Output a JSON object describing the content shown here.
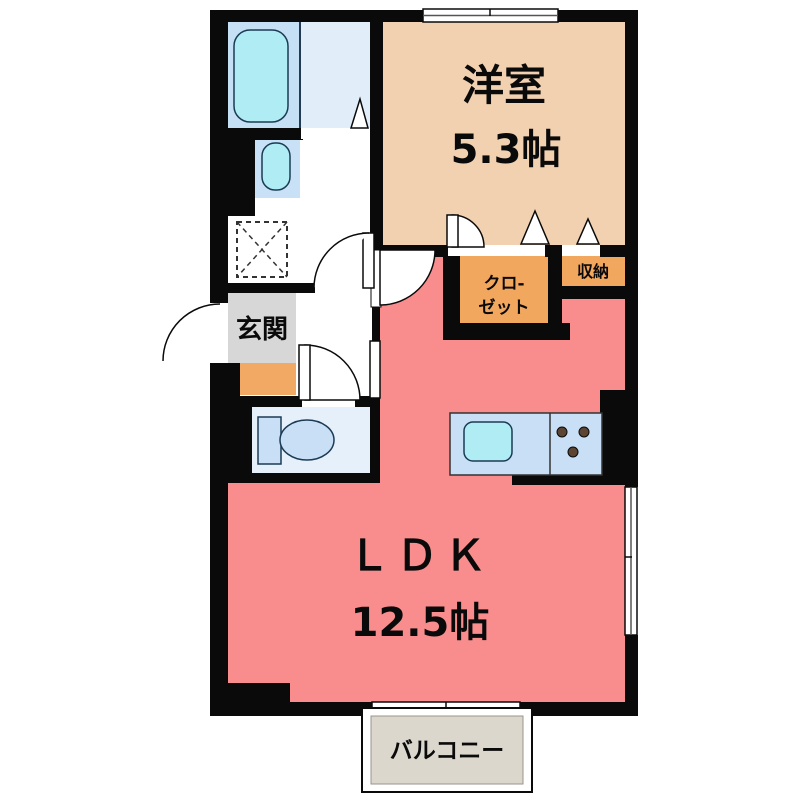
{
  "floor_plan": {
    "western_room": {
      "label": "洋室",
      "size": "5.3帖"
    },
    "ldk": {
      "label": "ＬＤＫ",
      "size": "12.5帖"
    },
    "genkan": {
      "label": "玄関"
    },
    "closet": {
      "label_line1": "クロ-",
      "label_line2": "ゼット"
    },
    "storage": {
      "label": "収納"
    },
    "balcony": {
      "label": "バルコニー"
    },
    "fixtures": [
      "bathtub",
      "washbasin",
      "toilet",
      "kitchen-sink",
      "stove-burners",
      "washing-machine-space"
    ]
  },
  "colors": {
    "wall": "#0a0a0a",
    "ldk": "#F98D8D",
    "western_room": "#F2D1B0",
    "closet": "#F2A75F",
    "storage": "#F2A75F",
    "genkan_floor": "#D7D7D7",
    "step": "#F2A964",
    "bath_left": "#C5DFF4",
    "bath_right": "#E1EEFA",
    "washbasin_panel": "#C9E1F6",
    "toilet_room": "#E6F0FA",
    "fixture_panel": "#C9DFF5",
    "fixture_cyan": "#AFECF4",
    "balcony_floor": "#DBD7CD",
    "burner": "#5C4633"
  }
}
